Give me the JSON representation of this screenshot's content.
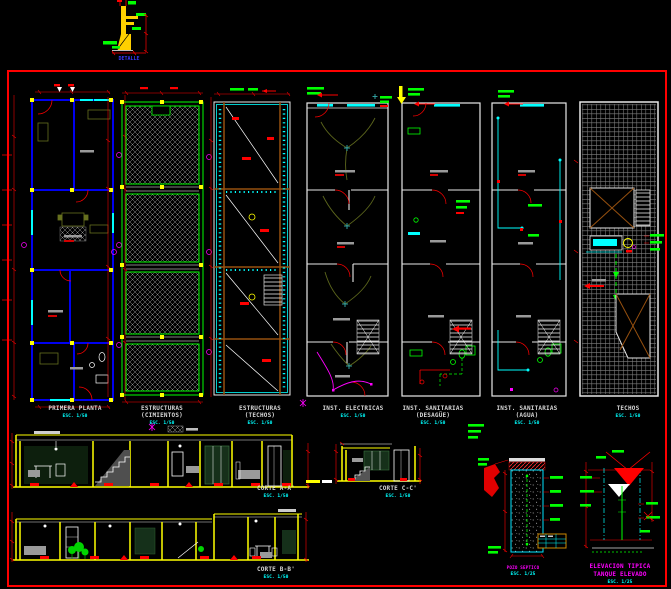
{
  "top_detail": {
    "label": "DETALLE"
  },
  "plans": [
    {
      "line1": "PRIMERA PLANTA",
      "scale": "ESC. 1/50"
    },
    {
      "line1": "ESTRUCTURAS",
      "line2": "(CIMIENTOS)",
      "scale": "ESC. 1/50"
    },
    {
      "line1": "ESTRUCTURAS",
      "line2": "(TECHOS)",
      "scale": "ESC. 1/50"
    },
    {
      "line1": "INST. ELECTRICAS",
      "scale": "ESC. 1/50"
    },
    {
      "line1": "INST. SANITARIAS",
      "line2": "(DESAGÜE)",
      "scale": "ESC. 1/50"
    },
    {
      "line1": "INST. SANITARIAS",
      "line2": "(AGUA)",
      "scale": "ESC. 1/50"
    },
    {
      "line1": "TECHOS",
      "scale": "ESC. 1/50"
    }
  ],
  "sections": [
    {
      "label": "CORTE A-A'",
      "scale": "ESC. 1/50"
    },
    {
      "label": "CORTE C-C'",
      "scale": "ESC. 1/50"
    },
    {
      "label": "CORTE B-B'",
      "scale": "ESC. 1/50"
    }
  ],
  "details": {
    "pozo": {
      "label": "POZO SEPTICO",
      "scale": "ESC. 1/25"
    },
    "tanque": {
      "line1": "ELEVACION TIPICA",
      "line2": "TANQUE ELEVADO",
      "scale": "ESC. 1/25"
    }
  },
  "colors": {
    "border": "#ff0000",
    "arch_walls": "#0000f0",
    "structure": "#00ff00",
    "water": "#00ffff",
    "sections": "#ffff00",
    "wiring": "#ff00ff",
    "beams": "#96500f",
    "titles": "#d8d8d8",
    "scale_text": "#00ffff",
    "detail_titles": "#ff00ff"
  }
}
